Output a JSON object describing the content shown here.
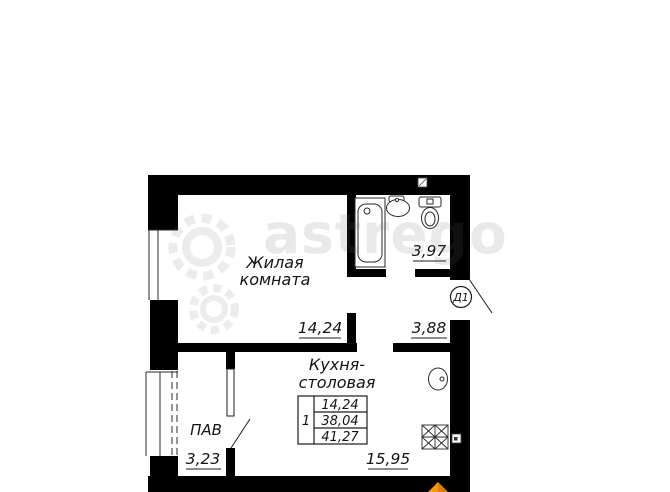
{
  "watermark": {
    "text": "astrego"
  },
  "plan": {
    "rooms": {
      "living": {
        "name_line1": "Жилая",
        "name_line2": "комната",
        "area": "14,24"
      },
      "kitchen": {
        "name_line1": "Кухня-",
        "name_line2": "столовая",
        "area": "15,95"
      },
      "bathroom": {
        "area": "3,97"
      },
      "hall": {
        "area": "3,88"
      },
      "balcony": {
        "name": "ПАВ",
        "area": "3,23"
      }
    },
    "door_label": "Д1",
    "area_table": {
      "rooms": "1",
      "living_area": "14,24",
      "apartment_area": "38,04",
      "total_area": "41,27"
    },
    "colors": {
      "wall": "#000000",
      "line": "#1c1c1c",
      "watermark_grey": "#ededed",
      "logo_orange": "#f2960f",
      "logo_orange_dark": "#d97f06"
    }
  }
}
